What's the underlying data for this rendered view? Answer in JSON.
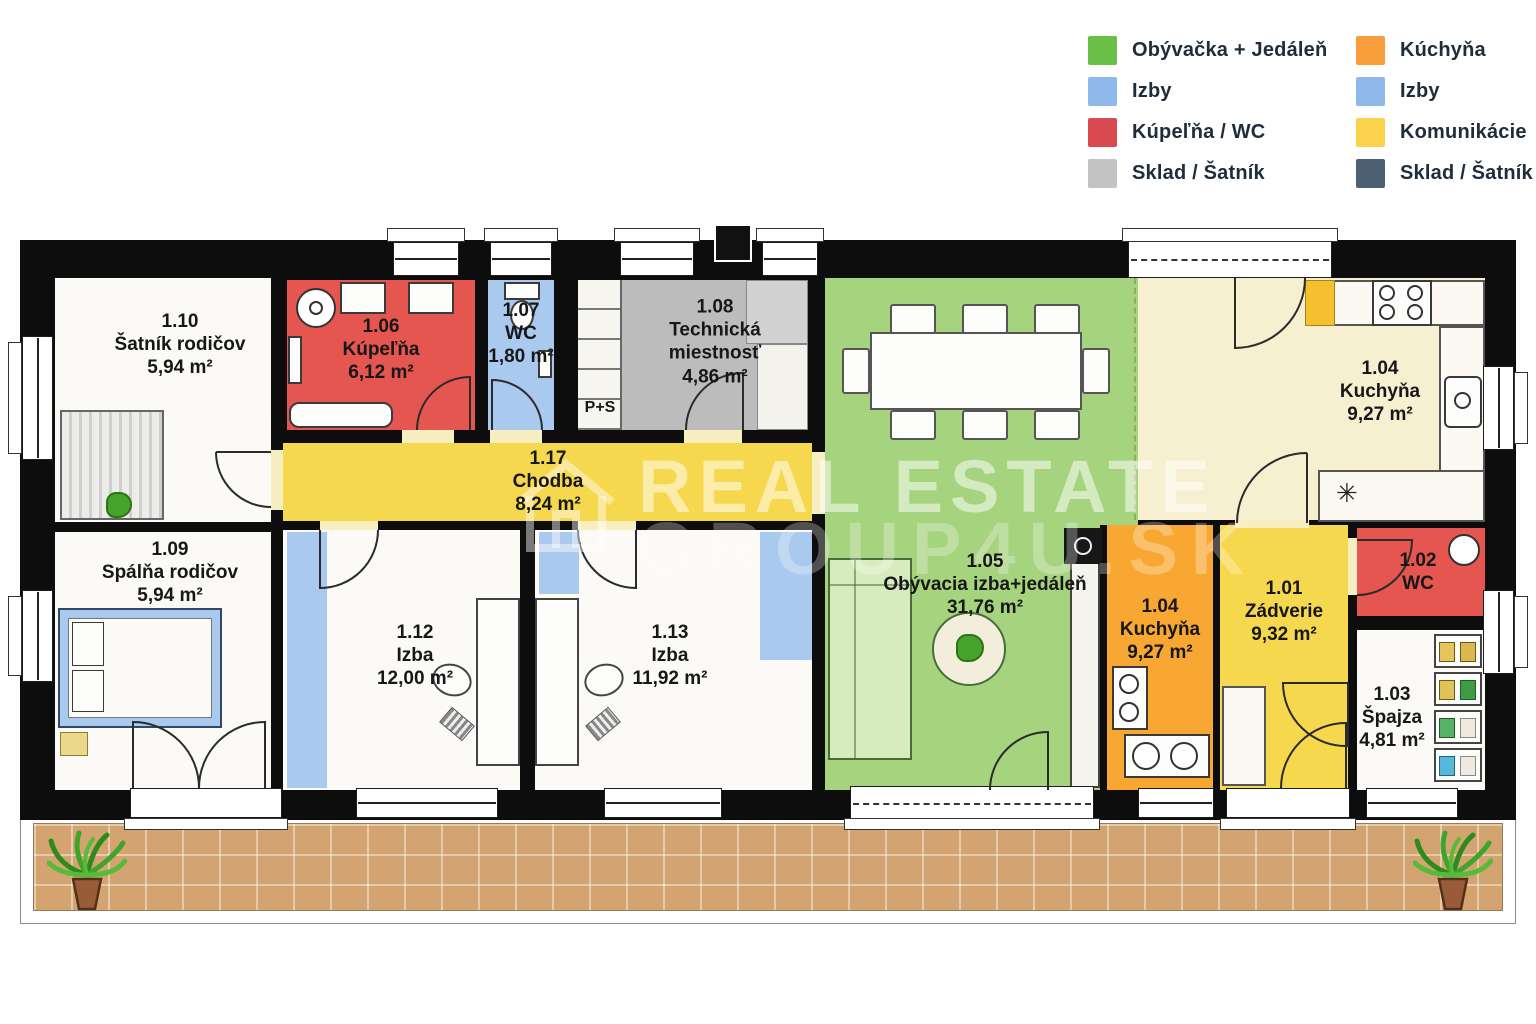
{
  "legend": {
    "items": [
      {
        "label": "Obývačka + Jedáleň",
        "color": "#6abf47"
      },
      {
        "label": "Izby",
        "color": "#8fb9ea"
      },
      {
        "label": "Kúpeľňa / WC",
        "color": "#d84a50"
      },
      {
        "label": "Sklad / Šatník",
        "color": "#c3c3c3"
      },
      {
        "label": "Kúchyňa",
        "color": "#f89d3c"
      },
      {
        "label": "Izby",
        "color": "#8fb9ea"
      },
      {
        "label": "Komunikácie",
        "color": "#fbd24b"
      },
      {
        "label": "Sklad / Šatník",
        "color": "#4e6172"
      }
    ]
  },
  "watermark": {
    "line1": "REAL ESTATE",
    "line2": "GROUP4U.SK"
  },
  "palette": {
    "living_green": "#a6d37d",
    "rooms_blue": "#a9c9ef",
    "bath_red": "#e4564f",
    "storage_gray": "#bcbcbc",
    "kitchen_orange": "#f8a832",
    "comm_yellow": "#f6d84e",
    "kitchen_cream": "#f7f0d0",
    "room_white": "#fbfaf6",
    "terrace_tan": "#d4a470"
  },
  "plan": {
    "rooms": [
      {
        "id": "1.10",
        "name": "Šatník rodičov",
        "area": "5,94 m²"
      },
      {
        "id": "1.06",
        "name": "Kúpeľňa",
        "area": "6,12 m²"
      },
      {
        "id": "1.07",
        "name": "WC",
        "area": "1,80 m²"
      },
      {
        "id": "1.08",
        "name": "Technická miestnosť",
        "area": "4,86 m²"
      },
      {
        "id": "1.17",
        "name": "Chodba",
        "area": "8,24 m²"
      },
      {
        "id": "1.04",
        "name": "Kuchyňa",
        "area": "9,27 m²"
      },
      {
        "id": "1.09",
        "name": "Spálňa rodičov",
        "area": "5,94 m²"
      },
      {
        "id": "1.12",
        "name": "Izba",
        "area": "12,00 m²"
      },
      {
        "id": "1.13",
        "name": "Izba",
        "area": "11,92 m²"
      },
      {
        "id": "1.05",
        "name": "Obývacia izba+jedáleň",
        "area": "31,76 m²"
      },
      {
        "id": "1.04",
        "name": "Kuchyňa",
        "area": "9,27 m²"
      },
      {
        "id": "1.01",
        "name": "Zádverie",
        "area": "9,32 m²"
      },
      {
        "id": "1.02",
        "name": "WC",
        "area": ""
      },
      {
        "id": "1.03",
        "name": "Špajza",
        "area": "4,81 m²"
      }
    ],
    "annotations": {
      "washer_dryer": "P+S",
      "dishwasher_symbol": "✳"
    }
  }
}
